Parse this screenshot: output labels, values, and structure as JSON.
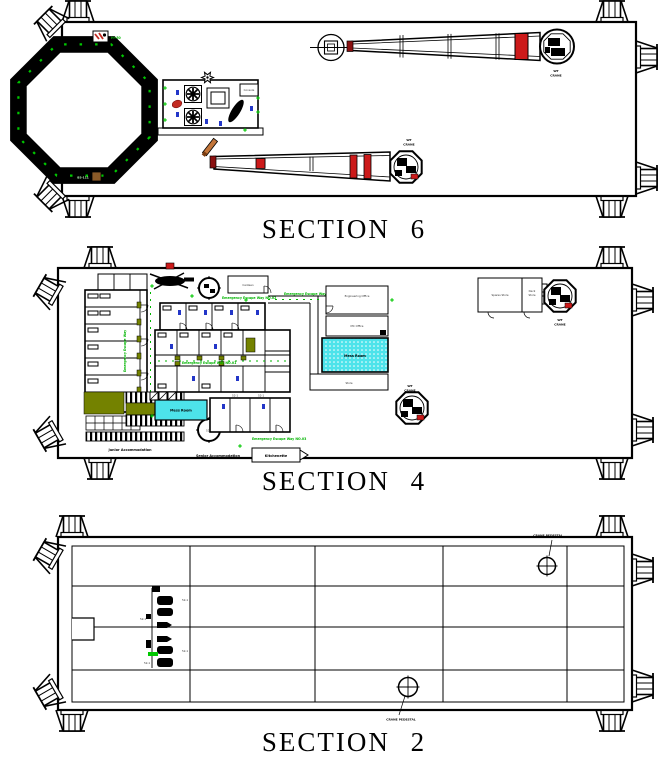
{
  "titles": {
    "section6": "SECTION 6",
    "section4": "SECTION 4",
    "section2": "SECTION 2"
  },
  "colors": {
    "ink": "#000000",
    "escape_green": "#00b400",
    "marker_green": "#00c800",
    "mess_cyan": "#4de3ea",
    "corridor_olive": "#748200",
    "crane_red": "#cc1a1a",
    "equipment_blue": "#2336c8",
    "boom_rest_orange": "#c2753a"
  },
  "section6": {
    "labels": {
      "wt": "WT",
      "crane": "CRANE",
      "helideck_code": "B5-111",
      "wind_marker": "H+50",
      "cabinet": "Console"
    }
  },
  "section4": {
    "labels": {
      "junior_accommodation": "Junior Accommodation",
      "senior_accommodation": "Senior Accommodation",
      "kitchenette": "Kitchenette",
      "canteen": "Canteen",
      "mess_room": "Mess Room",
      "engineering_office": "Engineering Office",
      "mc_office": "MC Office",
      "store": "Store",
      "spares_store": "Spares Store",
      "deck": "Deck",
      "deck_store": "Store",
      "wt": "WT",
      "crane": "CRANE",
      "escape_way_1": "Emergency Escape Way NO.01",
      "escape_way_2": "Emergency Escape Way NO.02",
      "escape_way_3": "Emergency Escape Way NO.03",
      "escape_way_v": "Emergency Escape Way",
      "cabin_code": "52-1",
      "binnacle_code": "52.1"
    }
  },
  "section2": {
    "labels": {
      "crane_pedestal": "CRANE PEDESTAL",
      "code": "52-1"
    }
  }
}
